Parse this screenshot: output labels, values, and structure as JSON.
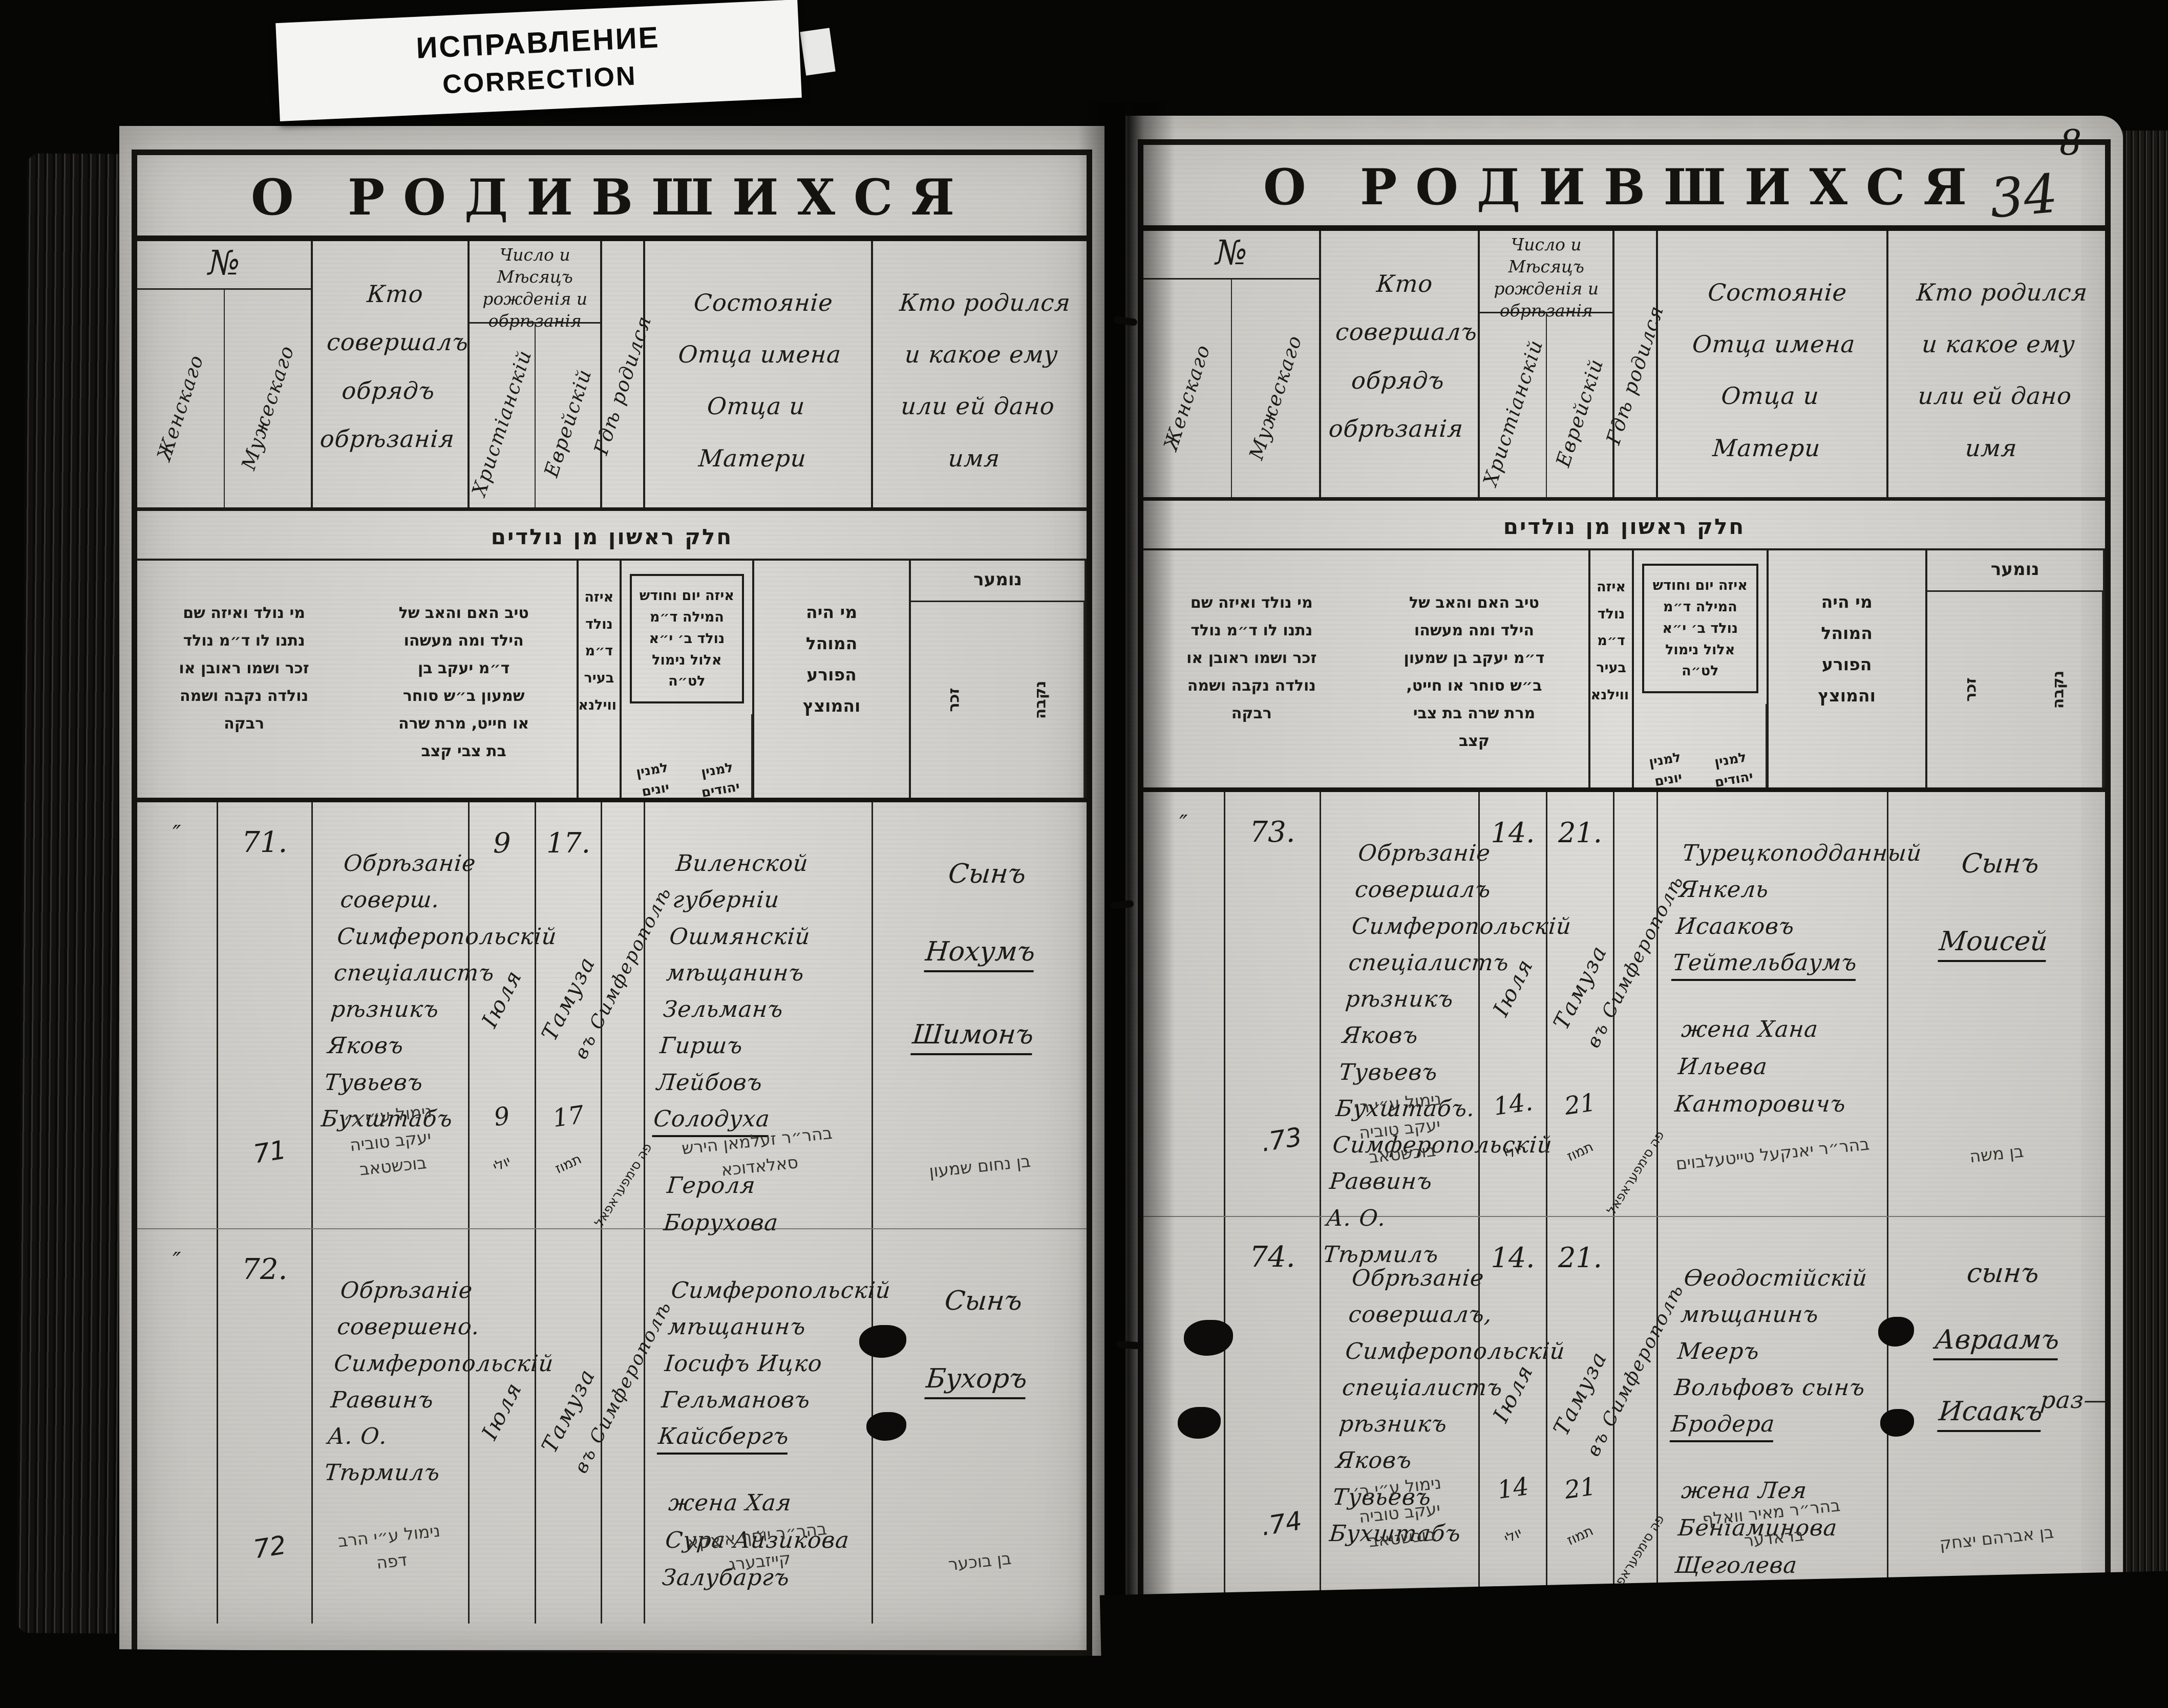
{
  "document": {
    "correction_label": {
      "line1": "ИСПРАВЛЕНИЕ",
      "line2": "CORRECTION"
    },
    "folio_number": "8",
    "page_number": "34"
  },
  "headers": {
    "title": "О РОДИВШИХСЯ",
    "no": "№",
    "col_female": "Женскаго",
    "col_male": "Мужескаго",
    "who_performed": "Кто совершалъ обрядъ обрѣзанія",
    "date_group": "Число и Мѣсяцъ рожденія и обрѣзанія",
    "col_christian": "Христіанскій",
    "col_jewish": "Еврейскій",
    "where_born": "Гдѣ родился",
    "father_status": "Состояніе Отца имена Отца и Матери",
    "who_was_born": "Кто родился и какое ему или ей дано имя"
  },
  "hebrew_headers": {
    "part_title": "חלק ראשון מן נולדים",
    "numer": "נומער",
    "female": "נקבה",
    "male": "זכר",
    "mohel": "מי היה המוהל הפורע והמוצץ",
    "date_note": "איזה יום וחודש המילה ד״מ נולד ב׳ י״א אלול נימול לט״ה",
    "jewish_count": "למנין יהודים",
    "greek_count": "למנין יונים",
    "where_note": "איזה נולד ד״מ בעיר ווילנא",
    "parents_note": "טיב האם והאב של הילד ומה מעשהו ד״מ יעקב בן שמעון ב״ש סוחר או חייט, מרת שרה בת צבי קצב",
    "child_note": "מי נולד ואיזה שם נתנו לו ד״מ נולד זכר ושמו ראובן או נולדה נקבה ושמה רבקה"
  },
  "records": {
    "r71": {
      "female_mark": "″",
      "number": "71.",
      "mohel": "Обрѣзаніе соверш. Симферопольскій спеціалистъ рѣзникъ Яковъ Тувьевъ Бухштабъ",
      "christian_day": "9",
      "christian_month": "Іюля",
      "jewish_day": "17.",
      "jewish_month": "Тамуза",
      "birthplace": "въ Симферополѣ",
      "father_part1": "Виленской губерніи Ошмянскій мѣщанинъ Зельманъ Гиршъ Лейбовъ",
      "father_name": "Солодуха",
      "father_part2": "Героля Борухова",
      "child_prefix": "Сынъ",
      "child_name1": "Нохумъ",
      "child_name2": "Шимонъ",
      "heb": {
        "number": "71",
        "mohel": "נימול ע״י ר׳ יעקב טוביה בוכשטאב",
        "christian_day": "9",
        "christian_month": "יולי",
        "jewish_day": "17",
        "jewish_month": "תמוז",
        "birthplace": "פה סימפעראפאל",
        "father": "בהר״ר זעלמאן הירש סאלאדוכא",
        "child": "בן נחום שמעון"
      }
    },
    "r72": {
      "female_mark": "″",
      "number": "72.",
      "mohel": "Обрѣзаніе совершено. Симферопольскій Раввинъ А. О. Тѣрмилъ",
      "christian_month": "Іюля",
      "jewish_month": "Тамуза",
      "birthplace": "въ Симферополѣ",
      "father_part1": "Симферопольскій мѣщанинъ Іосифъ Ицко Гельмановъ",
      "father_name": "Кайсбергъ",
      "father_part2": "жена Хая Сура Айзикова Залубаргъ",
      "child_prefix": "Сынъ",
      "child_name1": "Бухоръ",
      "heb": {
        "number": "72",
        "mohel": "נימול ע״י הרב דפה",
        "father": "בהר״ר יוסף איצקא קייזבערג",
        "child": "בן בוכער"
      }
    },
    "r73": {
      "female_mark": "″",
      "number": "73.",
      "mohel": "Обрѣзаніе совершалъ Симферопольскій спеціалистъ рѣзникъ Яковъ Тувьевъ Бухштабъ. Симферопольскій Раввинъ А. О. Тѣрмилъ",
      "christian_day": "14.",
      "christian_month": "Іюля",
      "jewish_day": "21.",
      "jewish_month": "Тамуза",
      "birthplace": "въ Симферополѣ",
      "father_part1": "Турецкоподданный Янкель Исааковъ",
      "father_name": "Тейтельбаумъ",
      "father_part2": "жена Хана Ильева Канторовичъ",
      "child_prefix": "Сынъ",
      "child_name1": "Моисей",
      "heb": {
        "number": "73.",
        "mohel": "נימול ע״י ר׳ יעקב טוביה בוכשטאב",
        "christian_day": "14.",
        "christian_month": "יולי",
        "jewish_day": "21",
        "jewish_month": "תמוז",
        "birthplace": "פה סימפעראפאל",
        "father": "בהר״ר יאנקעל טייטעלבוים",
        "child": "בן משה"
      }
    },
    "r74": {
      "number": "74.",
      "mohel": "Обрѣзаніе совершалъ, Симферопольскій спеціалистъ рѣзникъ Яковъ Тувьевъ Бухштабъ",
      "christian_day": "14.",
      "christian_month": "Іюля",
      "jewish_day": "21.",
      "jewish_month": "Тамуза",
      "birthplace": "въ Симферополѣ",
      "father_part1": "Ѳеодостійскій мѣщанинъ Мееръ Вольфовъ сынъ",
      "father_name": "Бродера",
      "father_part2": "жена Лея Беніаминова Щеголева",
      "child_prefix": "сынъ",
      "child_name1": "Авраамъ",
      "child_name2": "Исаакъ",
      "margin_note": "раз—",
      "heb": {
        "number": "74.",
        "mohel": "נימול ע״י ר׳ יעקב טוביה בוכשטאב",
        "christian_day": "14",
        "christian_month": "יולי",
        "jewish_day": "21",
        "jewish_month": "תמוז",
        "birthplace": "פה סימפעראפאל",
        "father": "בהר״ר מאיר וואלף בראדער",
        "child": "בן אברהם יצחק"
      }
    }
  }
}
